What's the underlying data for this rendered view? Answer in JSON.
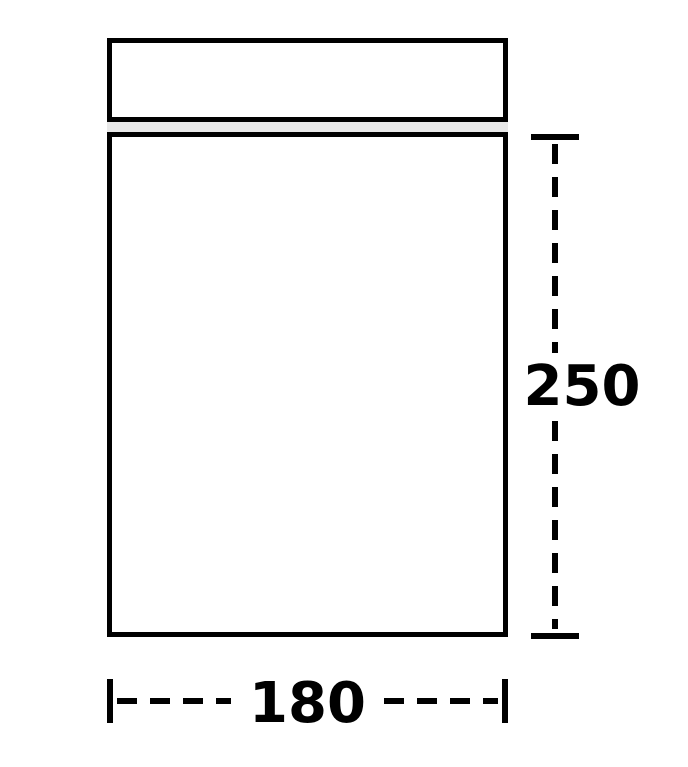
{
  "diagram": {
    "kind": "bag-dimension-diagram",
    "height_label": "250",
    "width_label": "180",
    "colors": {
      "line": "#000000",
      "zipper_fill": "#e8e8e8",
      "background": "#ffffff"
    }
  }
}
